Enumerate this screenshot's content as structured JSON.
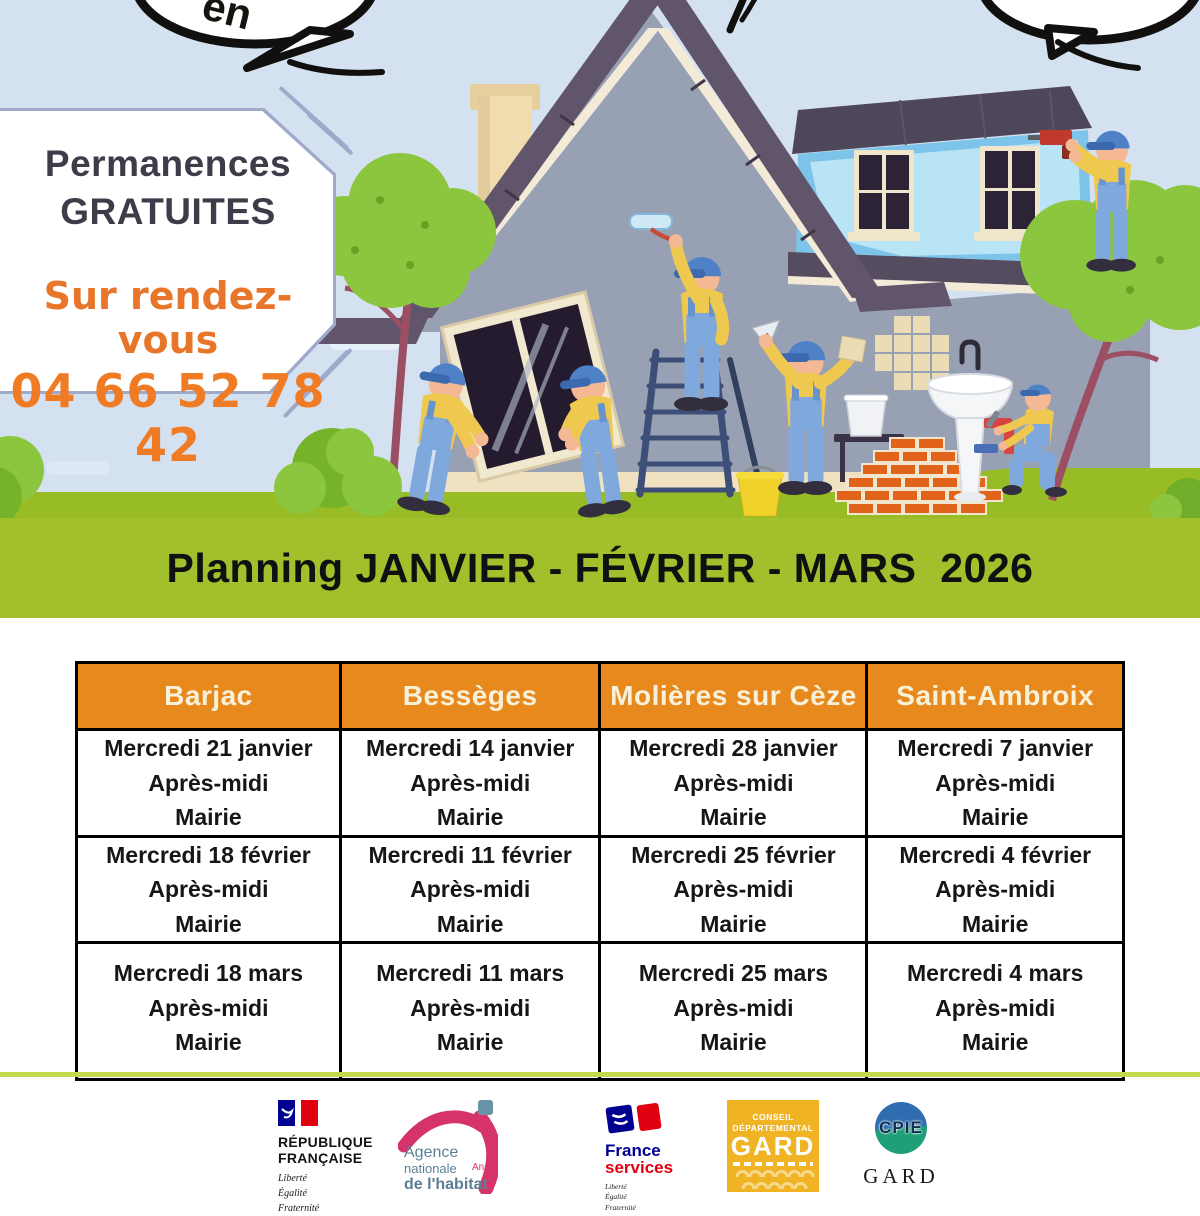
{
  "colors": {
    "sky": "#d4e1f1",
    "banner_green": "#a2c02c",
    "grass_green": "#97bc25",
    "header_orange": "#e8891e",
    "accent_orange": "#e8762a",
    "title_dark": "#3f3b49",
    "table_border": "#000000",
    "divider_green": "#c5d94f"
  },
  "speech": {
    "left_bubble_text": "en"
  },
  "info_box": {
    "title_line1": "Permanences",
    "title_line2": "GRATUITES",
    "subtitle": "Sur rendez-vous",
    "phone": "04 66 52 78 42"
  },
  "banner": {
    "title": "Planning JANVIER - FÉVRIER - MARS  2026"
  },
  "schedule": {
    "headers": [
      "Barjac",
      "Bessèges",
      "Molières sur Cèze",
      "Saint-Ambroix"
    ],
    "rows": [
      {
        "cells": [
          {
            "date": "Mercredi 21 janvier",
            "time": "Après-midi",
            "place": "Mairie"
          },
          {
            "date": "Mercredi 14 janvier",
            "time": "Après-midi",
            "place": "Mairie"
          },
          {
            "date": "Mercredi 28 janvier",
            "time": "Après-midi",
            "place": "Mairie"
          },
          {
            "date": "Mercredi 7 janvier",
            "time": "Après-midi",
            "place": "Mairie"
          }
        ]
      },
      {
        "cells": [
          {
            "date": "Mercredi 18 février",
            "time": "Après-midi",
            "place": "Mairie"
          },
          {
            "date": "Mercredi 11 février",
            "time": "Après-midi",
            "place": "Mairie"
          },
          {
            "date": "Mercredi 25 février",
            "time": "Après-midi",
            "place": "Mairie"
          },
          {
            "date": "Mercredi 4 février",
            "time": "Après-midi",
            "place": "Mairie"
          }
        ]
      },
      {
        "cells": [
          {
            "date": "Mercredi 18 mars",
            "time": "Après-midi",
            "place": "Mairie"
          },
          {
            "date": "Mercredi 11 mars",
            "time": "Après-midi",
            "place": "Mairie"
          },
          {
            "date": "Mercredi 25 mars",
            "time": "Après-midi",
            "place": "Mairie"
          },
          {
            "date": "Mercredi 4 mars",
            "time": "Après-midi",
            "place": "Mairie"
          }
        ]
      }
    ]
  },
  "footer": {
    "republique": {
      "line1": "RÉPUBLIQUE",
      "line2": "FRANÇAISE",
      "motto1": "Liberté",
      "motto2": "Égalité",
      "motto3": "Fraternité"
    },
    "anah": {
      "line1": "Agence",
      "line2": "nationale",
      "line3": "de l'habitat",
      "abbr": "Anah"
    },
    "france_services": {
      "line1": "France",
      "line2": "services",
      "motto1": "Liberté",
      "motto2": "Égalité",
      "motto3": "Fraternité"
    },
    "gard_departement": {
      "top1": "CONSEIL",
      "top2": "DÉPARTEMENTAL",
      "name": "GARD"
    },
    "cpie": {
      "abbr": "CPIE",
      "name": "GARD"
    }
  }
}
